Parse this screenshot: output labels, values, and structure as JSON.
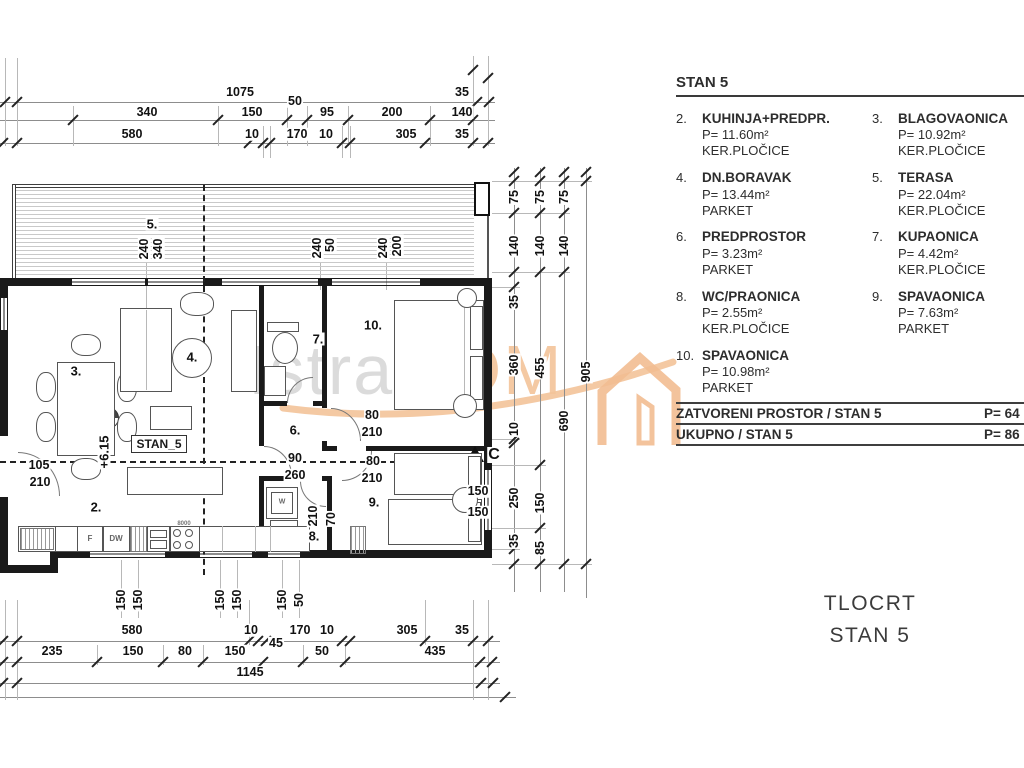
{
  "legend": {
    "title": "STAN 5",
    "items": [
      {
        "num": "2.",
        "name": "KUHINJA+PREDPR.",
        "area": "P= 11.60m²",
        "floor": "KER.PLOČICE"
      },
      {
        "num": "3.",
        "name": "BLAGOVAONICA",
        "area": "P= 10.92m²",
        "floor": "KER.PLOČICE"
      },
      {
        "num": "4.",
        "name": "DN.BORAVAK",
        "area": "P= 13.44m²",
        "floor": "PARKET"
      },
      {
        "num": "5.",
        "name": "TERASA",
        "area": "P= 22.04m²",
        "floor": "KER.PLOČICE"
      },
      {
        "num": "6.",
        "name": "PREDPROSTOR",
        "area": "P= 3.23m²",
        "floor": "PARKET"
      },
      {
        "num": "7.",
        "name": "KUPAONICA",
        "area": "P= 4.42m²",
        "floor": "KER.PLOČICE"
      },
      {
        "num": "8.",
        "name": "WC/PRAONICA",
        "area": "P= 2.55m²",
        "floor": "KER.PLOČICE"
      },
      {
        "num": "9.",
        "name": "SPAVAONICA",
        "area": "P= 7.63m²",
        "floor": "PARKET"
      },
      {
        "num": "10.",
        "name": "SPAVAONICA",
        "area": "P= 10.98m²",
        "floor": "PARKET"
      }
    ],
    "totals": [
      {
        "label": "ZATVORENI PROSTOR / STAN 5",
        "value": "P= 64"
      },
      {
        "label": "UKUPNO / STAN 5",
        "value": "P= 86"
      }
    ]
  },
  "drawing_title": {
    "line1": "TLOCRT",
    "line2": "STAN 5"
  },
  "watermark": {
    "word1": "Istra",
    "word2": "DOM"
  },
  "plan": {
    "unit_label": "STAN_5",
    "room_numbers": [
      {
        "t": "2.",
        "x": 96,
        "y": 507,
        "s": 13,
        "n": "room-number"
      },
      {
        "t": "3.",
        "x": 76,
        "y": 371,
        "s": 13,
        "n": "room-number"
      },
      {
        "t": "4.",
        "x": 192,
        "y": 357,
        "s": 13,
        "n": "room-number"
      },
      {
        "t": "5.",
        "x": 152,
        "y": 224,
        "s": 13,
        "n": "room-number"
      },
      {
        "t": "6.",
        "x": 295,
        "y": 430,
        "s": 13,
        "n": "room-number"
      },
      {
        "t": "7.",
        "x": 318,
        "y": 339,
        "s": 13,
        "n": "room-number"
      },
      {
        "t": "8.",
        "x": 314,
        "y": 536,
        "s": 13,
        "n": "room-number"
      },
      {
        "t": "9.",
        "x": 374,
        "y": 502,
        "s": 13,
        "n": "room-number"
      },
      {
        "t": "10.",
        "x": 373,
        "y": 325,
        "s": 13,
        "n": "room-number"
      }
    ],
    "annotations": [
      {
        "t": "105",
        "x": 39,
        "y": 465
      },
      {
        "t": "210",
        "x": 40,
        "y": 482
      },
      {
        "t": "90",
        "x": 295,
        "y": 458
      },
      {
        "t": "260",
        "x": 295,
        "y": 475
      },
      {
        "t": "80",
        "x": 372,
        "y": 415
      },
      {
        "t": "210",
        "x": 372,
        "y": 432
      },
      {
        "t": "80",
        "x": 373,
        "y": 461
      },
      {
        "t": "210",
        "x": 372,
        "y": 478
      },
      {
        "t": "150",
        "x": 478,
        "y": 491
      },
      {
        "t": "150",
        "x": 478,
        "y": 512
      },
      {
        "t": "C",
        "x": 494,
        "y": 455,
        "s": 16,
        "n": "section-marker-label"
      },
      {
        "t": "340",
        "x": 158,
        "y": 249,
        "r": 1
      },
      {
        "t": "240",
        "x": 144,
        "y": 249,
        "r": 1
      },
      {
        "t": "50",
        "x": 330,
        "y": 245,
        "r": 1
      },
      {
        "t": "240",
        "x": 317,
        "y": 248,
        "r": 1
      },
      {
        "t": "200",
        "x": 397,
        "y": 246,
        "r": 1
      },
      {
        "t": "240",
        "x": 383,
        "y": 248,
        "r": 1
      },
      {
        "t": "+6.15",
        "x": 104,
        "y": 452,
        "r": 1,
        "s": 13,
        "n": "level-label"
      },
      {
        "t": "210",
        "x": 313,
        "y": 516,
        "r": 1
      },
      {
        "t": "70",
        "x": 331,
        "y": 519,
        "r": 1
      },
      {
        "t": "F",
        "x": 90,
        "y": 539,
        "s": 8,
        "c": "#666",
        "b": 0,
        "n": "fridge-label"
      },
      {
        "t": "DW",
        "x": 116,
        "y": 539,
        "s": 8,
        "c": "#666",
        "b": 0,
        "n": "dishwasher-label"
      },
      {
        "t": "W",
        "x": 282,
        "y": 502,
        "s": 7,
        "c": "#666",
        "b": 0,
        "n": "washer-label"
      },
      {
        "t": "8000",
        "x": 184,
        "y": 524,
        "s": 6,
        "c": "#777",
        "b": 0,
        "n": "stove-label"
      }
    ]
  },
  "dimensions": {
    "top": [
      {
        "t": "1075",
        "x": 240,
        "y": 92
      },
      {
        "t": "35",
        "x": 462,
        "y": 92
      },
      {
        "t": "340",
        "x": 147,
        "y": 112
      },
      {
        "t": "150",
        "x": 252,
        "y": 112
      },
      {
        "t": "50",
        "x": 295,
        "y": 101
      },
      {
        "t": "95",
        "x": 327,
        "y": 112
      },
      {
        "t": "200",
        "x": 392,
        "y": 112
      },
      {
        "t": "140",
        "x": 462,
        "y": 112
      },
      {
        "t": "580",
        "x": 132,
        "y": 134
      },
      {
        "t": "10",
        "x": 252,
        "y": 134
      },
      {
        "t": "170",
        "x": 297,
        "y": 134
      },
      {
        "t": "10",
        "x": 326,
        "y": 134
      },
      {
        "t": "305",
        "x": 406,
        "y": 134
      },
      {
        "t": "35",
        "x": 462,
        "y": 134
      }
    ],
    "bottom": [
      {
        "t": "580",
        "x": 132,
        "y": 630
      },
      {
        "t": "10",
        "x": 251,
        "y": 630
      },
      {
        "t": "45",
        "x": 276,
        "y": 643
      },
      {
        "t": "170",
        "x": 300,
        "y": 630
      },
      {
        "t": "10",
        "x": 327,
        "y": 630
      },
      {
        "t": "305",
        "x": 407,
        "y": 630
      },
      {
        "t": "35",
        "x": 462,
        "y": 630
      },
      {
        "t": "235",
        "x": 52,
        "y": 651
      },
      {
        "t": "150",
        "x": 133,
        "y": 651
      },
      {
        "t": "80",
        "x": 185,
        "y": 651
      },
      {
        "t": "150",
        "x": 235,
        "y": 651
      },
      {
        "t": "50",
        "x": 322,
        "y": 651
      },
      {
        "t": "435",
        "x": 435,
        "y": 651
      },
      {
        "t": "1145",
        "x": 250,
        "y": 672
      },
      {
        "t": "150",
        "x": 121,
        "y": 600,
        "r": 1
      },
      {
        "t": "150",
        "x": 138,
        "y": 600,
        "r": 1
      },
      {
        "t": "150",
        "x": 220,
        "y": 600,
        "r": 1
      },
      {
        "t": "150",
        "x": 237,
        "y": 600,
        "r": 1
      },
      {
        "t": "150",
        "x": 282,
        "y": 600,
        "r": 1
      },
      {
        "t": "50",
        "x": 299,
        "y": 600,
        "r": 1
      }
    ],
    "right": [
      {
        "t": "75",
        "x": 514,
        "y": 197,
        "r": 1
      },
      {
        "t": "140",
        "x": 514,
        "y": 246,
        "r": 1
      },
      {
        "t": "35",
        "x": 514,
        "y": 302,
        "r": 1
      },
      {
        "t": "360",
        "x": 514,
        "y": 365,
        "r": 1
      },
      {
        "t": "10",
        "x": 514,
        "y": 429,
        "r": 1
      },
      {
        "t": "250",
        "x": 514,
        "y": 498,
        "r": 1
      },
      {
        "t": "35",
        "x": 514,
        "y": 541,
        "r": 1
      },
      {
        "t": "75",
        "x": 540,
        "y": 197,
        "r": 1
      },
      {
        "t": "140",
        "x": 540,
        "y": 246,
        "r": 1
      },
      {
        "t": "455",
        "x": 540,
        "y": 368,
        "r": 1
      },
      {
        "t": "150",
        "x": 540,
        "y": 503,
        "r": 1
      },
      {
        "t": "85",
        "x": 540,
        "y": 548,
        "r": 1
      },
      {
        "t": "75",
        "x": 564,
        "y": 197,
        "r": 1
      },
      {
        "t": "140",
        "x": 564,
        "y": 246,
        "r": 1
      },
      {
        "t": "690",
        "x": 564,
        "y": 421,
        "r": 1
      },
      {
        "t": "905",
        "x": 586,
        "y": 372,
        "r": 1
      }
    ]
  },
  "colors": {
    "line": "#1a1a1a",
    "watermark_gray": "#d8d8d8",
    "watermark_orange": "#f3c49a"
  }
}
